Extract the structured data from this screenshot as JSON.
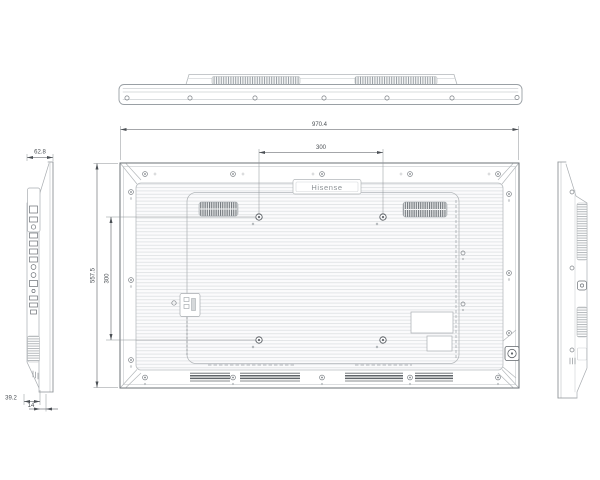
{
  "drawing": {
    "brand_logo": "Hisense",
    "dimensions": {
      "overall_width": "970.4",
      "vesa_width": "300",
      "overall_height": "557.5",
      "vesa_height": "300",
      "side_depth": "62.8",
      "bottom_depth": "39.2",
      "bottom_inset": "14"
    },
    "colors": {
      "background": "#ffffff",
      "line_light": "#b3b7ba",
      "line_medium": "#7d8287",
      "dimension_line": "#4a4f54",
      "grille_dark": "#70757a"
    }
  }
}
